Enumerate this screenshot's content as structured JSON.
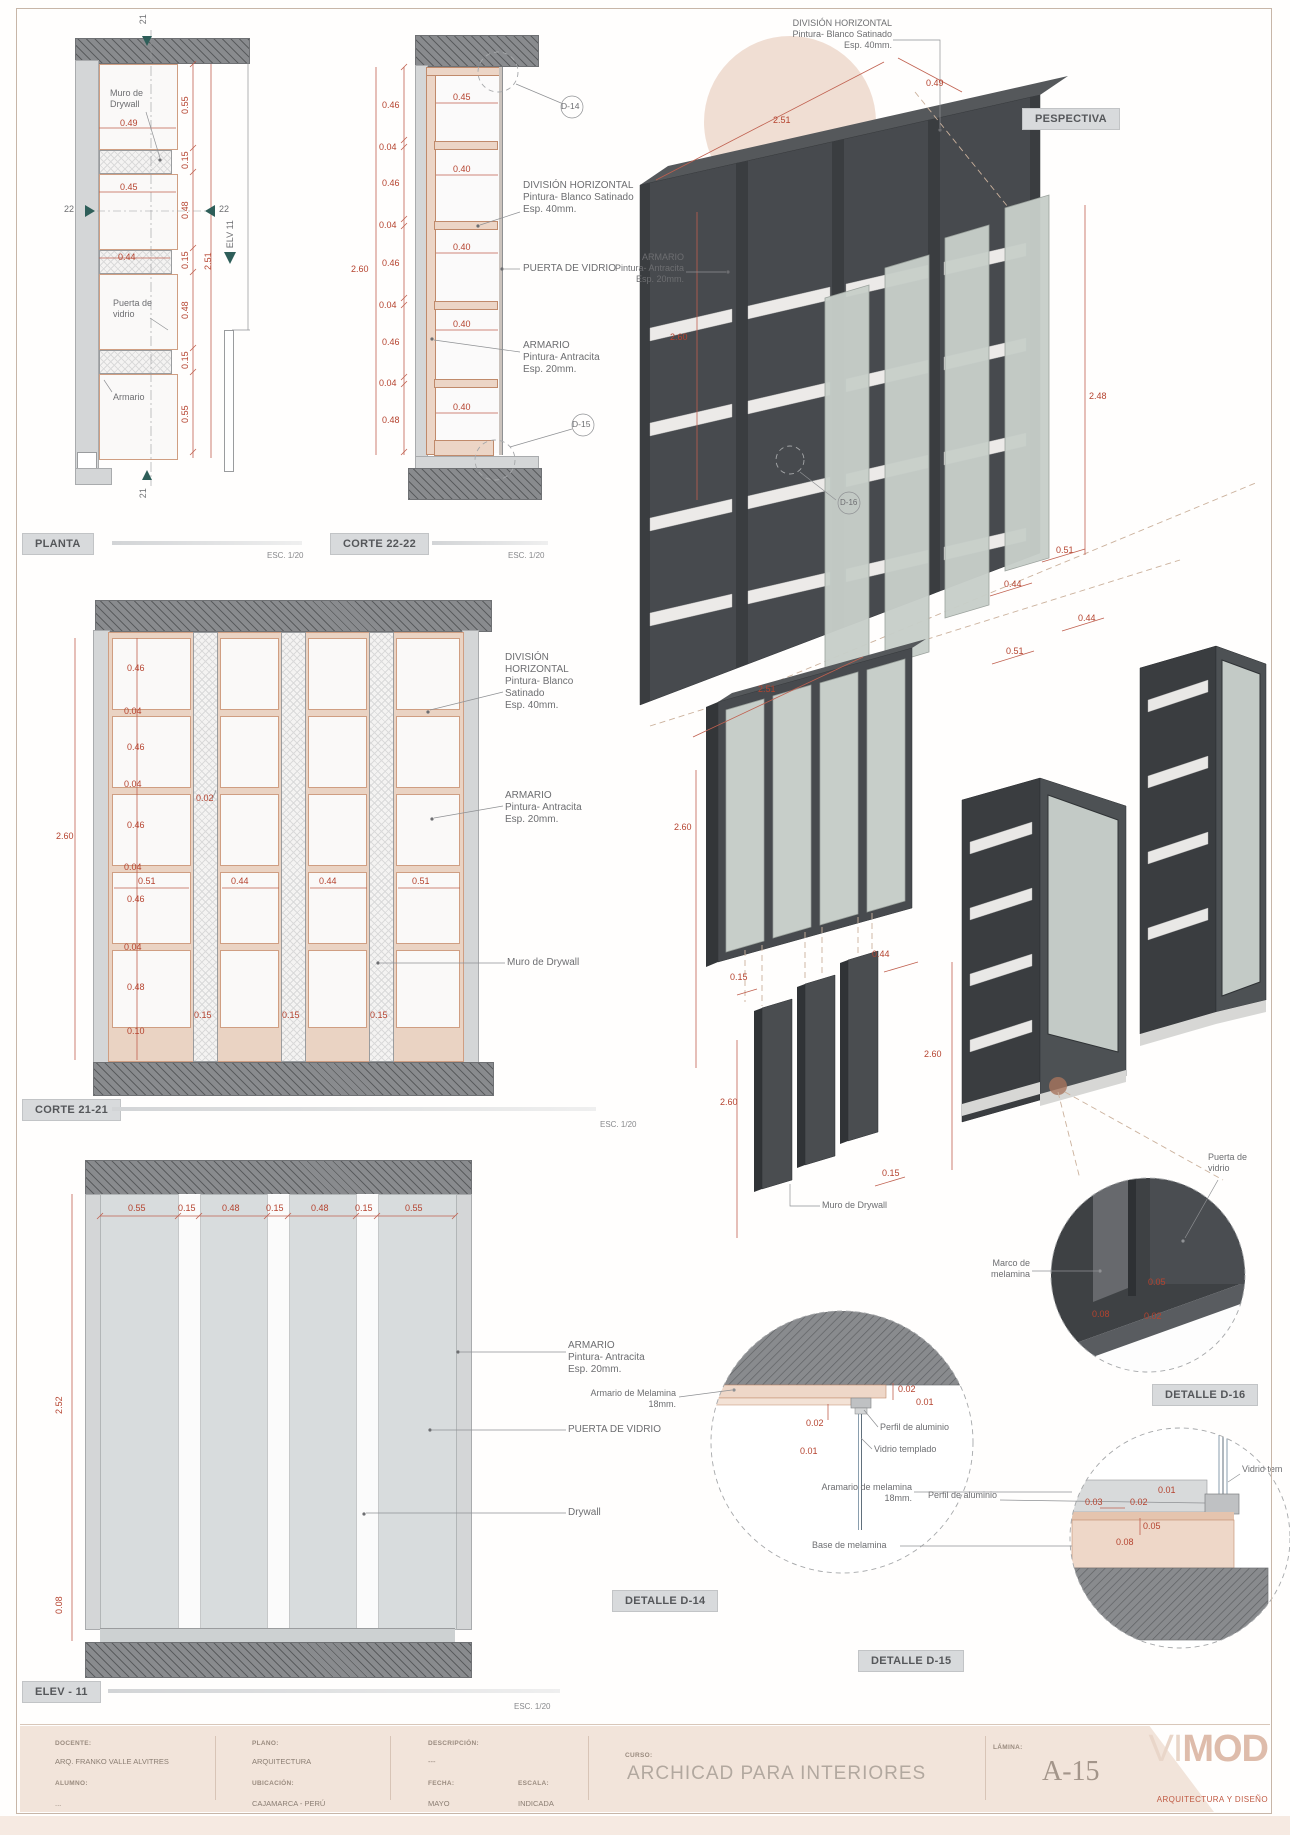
{
  "colors": {
    "dim_red": "#b5432f",
    "label_gray": "#6d6e71",
    "slab_gray": "#898b8e",
    "wall_gray": "#d4d6d7",
    "melamine_tan": "#ead3c3",
    "anthracite": "#474a4e",
    "shelf_white": "#eceae8",
    "glass_green": "#c7cec9",
    "accent_pink": "#e3c2b0",
    "badge_bg": "#d8dadc",
    "teal_marker": "#2e5e59",
    "logo_pink": "#debcab",
    "tagline_red": "#c05a43"
  },
  "scale_note": "ESC. 1/20",
  "badges": {
    "planta": "PLANTA",
    "corte22": "CORTE 22-22",
    "persp": "PESPECTIVA",
    "corte21": "CORTE 21-21",
    "elev": "ELEV - 11",
    "d14": "DETALLE D-14",
    "d15": "DETALLE D-15",
    "d16": "DETALLE D-16"
  },
  "planta": {
    "muro": [
      "Muro de",
      "Drywall"
    ],
    "puerta": [
      "Puerta de",
      "vidrio"
    ],
    "armario": "Armario",
    "w": [
      "0.49",
      "0.45",
      "0.44"
    ],
    "v": [
      "0.55",
      "0.15",
      "0.48",
      "0.15",
      "0.48",
      "0.15",
      "0.55"
    ],
    "total": "2.51",
    "m21": "21",
    "m22": "22",
    "elv": "ELV 11"
  },
  "corte22": {
    "left": [
      "0.46",
      "0.04",
      "0.46",
      "0.04",
      "0.46",
      "0.04",
      "0.46",
      "0.04",
      "0.48"
    ],
    "total": "2.60",
    "inner": [
      "0.45",
      "0.40",
      "0.40",
      "0.40",
      "0.40"
    ],
    "d14": "D-14",
    "d15": "D-15",
    "division": [
      "DIVISIÓN HORIZONTAL",
      "Pintura- Blanco Satinado",
      "Esp. 40mm."
    ],
    "puerta": "PUERTA DE VIDRIO",
    "armario": [
      "ARMARIO",
      "Pintura- Antracita",
      "Esp. 20mm."
    ]
  },
  "persp": {
    "division": [
      "DIVISIÓN HORIZONTAL",
      "Pintura- Blanco Satinado",
      "Esp. 40mm."
    ],
    "armario": [
      "ARMARIO",
      "Pintura- Antracita",
      "Esp. 20mm."
    ],
    "w": "2.51",
    "d": "0.49",
    "h": "2.60",
    "hd": "2.48",
    "doors": [
      "0.51",
      "0.44",
      "0.44",
      "0.51"
    ],
    "d16": "D-16"
  },
  "axon": {
    "w": "2.51",
    "h": "2.60",
    "p_t": "0.15",
    "p_w": "0.44",
    "p_h": "2.60",
    "p_h2": "2.60",
    "p_t2": "0.15",
    "muro": "Muro de Drywall"
  },
  "corte21": {
    "left": [
      "0.46",
      "0.04",
      "0.46",
      "0.04",
      "0.46",
      "0.04",
      "0.46",
      "0.04",
      "0.48",
      "0.10"
    ],
    "gap": "0.02",
    "total": "2.60",
    "row": [
      "0.51",
      "0.44",
      "0.44",
      "0.51"
    ],
    "b": [
      "0.15",
      "0.15",
      "0.15"
    ],
    "division": [
      "DIVISIÓN",
      "HORIZONTAL",
      "Pintura- Blanco",
      "Satinado",
      "Esp. 40mm."
    ],
    "armario": [
      "ARMARIO",
      "Pintura- Antracita",
      "Esp. 20mm."
    ],
    "muro": "Muro de Drywall"
  },
  "elev": {
    "top": [
      "0.55",
      "0.15",
      "0.48",
      "0.15",
      "0.48",
      "0.15",
      "0.55"
    ],
    "h": "2.52",
    "base": "0.08",
    "armario": [
      "ARMARIO",
      "Pintura- Antracita",
      "Esp. 20mm."
    ],
    "puerta": "PUERTA DE VIDRIO",
    "drywall": "Drywall"
  },
  "d16": {
    "marco": [
      "Marco de",
      "melamina"
    ],
    "puerta": [
      "Puerta de",
      "vidrio"
    ],
    "dims": [
      "0.05",
      "0.08",
      "0.02"
    ]
  },
  "d14": {
    "armario": [
      "Armario de Melamina",
      "18mm."
    ],
    "perfil": "Perfil de aluminio",
    "vidrio": "Vidrio templado",
    "dims": [
      "0.02",
      "0.01",
      "0.02",
      "0.01"
    ]
  },
  "d15": {
    "armario": [
      "Aramario de melamina",
      "18mm."
    ],
    "perfil": "Perfil de aluminio",
    "vidrio": "Vidrio tem",
    "base": "Base de melamina",
    "dims": [
      "0.03",
      "0.02",
      "0.01",
      "0.05",
      "0.08"
    ]
  },
  "titleblock": {
    "docente_label": "DOCENTE:",
    "docente": "ARQ. FRANKO VALLE ALVITRES",
    "alumno_label": "ALUMNO:",
    "alumno": "...",
    "plano_label": "PLANO:",
    "plano": "ARQUITECTURA",
    "ubicacion_label": "UBICACIÓN:",
    "ubicacion": "CAJAMARCA - PERÚ",
    "descripcion_label": "DESCRIPCIÓN:",
    "descripcion": "---",
    "fecha_label": "FECHA:",
    "fecha": "MAYO",
    "escala_label": "ESCALA:",
    "escala": "INDICADA",
    "curso_label": "CURSO:",
    "curso": "ARCHICAD PARA INTERIORES",
    "lamina_label": "LÁMINA:",
    "lamina": "A-15",
    "logo_vi": "VI",
    "logo_mod": "MOD",
    "tagline": "ARQUITECTURA Y DISEÑO"
  }
}
